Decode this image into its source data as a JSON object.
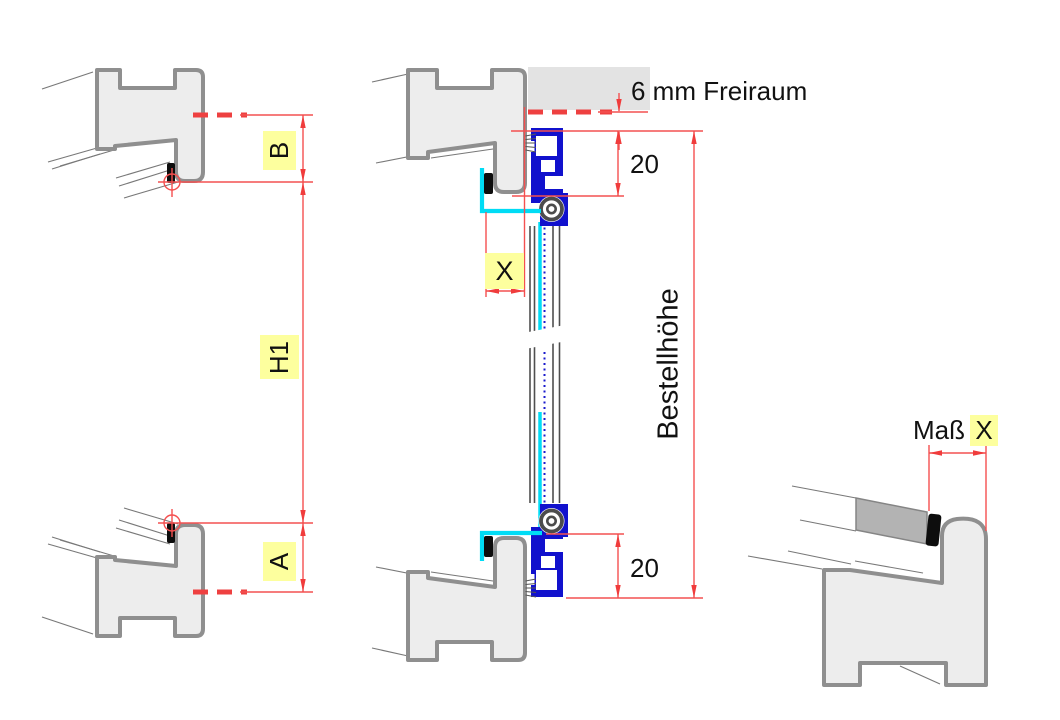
{
  "annotations": {
    "freiraum": "6 mm Freiraum",
    "gap_top": "20",
    "gap_bottom": "20",
    "order_height": "Bestellhöhe",
    "offset_top": "B",
    "offset_bottom": "A",
    "height_total": "H1",
    "clearance_x": "X",
    "measure_label": "Maß",
    "measure_value": "X"
  },
  "colors": {
    "dimension_red": "#f45050",
    "dashed_red": "#ee4040",
    "highlight_yellow": "#fdff9e",
    "profile_fill": "#ededed",
    "profile_outline": "#8f8f8f",
    "aluminium_blue": "#1111cd",
    "angle_cyan": "#00dcf5",
    "seal_black": "#0d0d0d",
    "panel_gray": "#b3b3b3",
    "lintel_gray": "#e3e3e3",
    "text_black": "#111111"
  }
}
